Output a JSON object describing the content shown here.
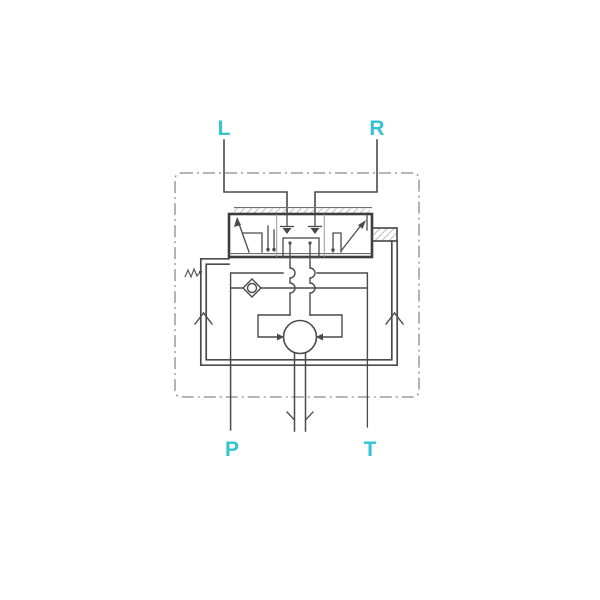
{
  "diagram_type": "hydraulic-directional-valve-schematic",
  "ports": {
    "top_left": "L",
    "top_right": "R",
    "bottom_left": "P",
    "bottom_right": "T"
  },
  "colors": {
    "port_label": "#35c2d2",
    "line_dark": "#4a4a4a",
    "line_light": "#6f6f6f",
    "dashed_boundary": "#8a8a8a",
    "background": "#ffffff"
  }
}
